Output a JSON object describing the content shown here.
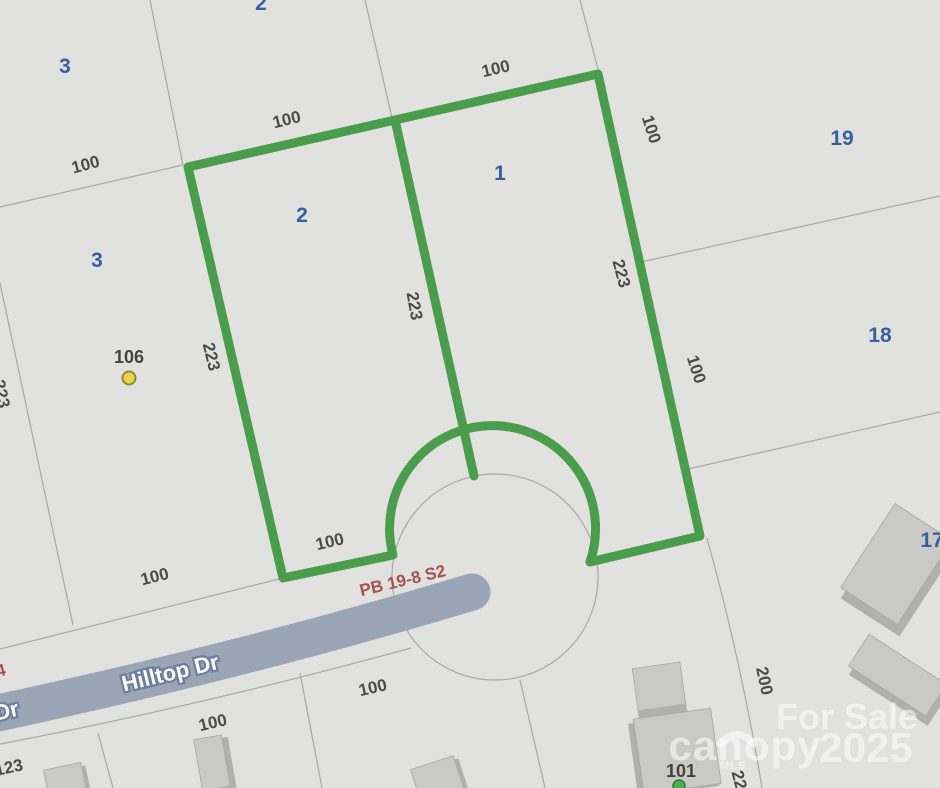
{
  "map": {
    "road": {
      "name": "Hilltop Dr",
      "name_partial": "Dr"
    },
    "plat": {
      "label": "PB 19-8 S2",
      "label_partial": "4"
    },
    "lot_numbers": [
      {
        "text": "3"
      },
      {
        "text": "2"
      },
      {
        "text": "3"
      },
      {
        "text": "2"
      },
      {
        "text": "1"
      },
      {
        "text": "19"
      },
      {
        "text": "18"
      },
      {
        "text": "17"
      }
    ],
    "dimensions": [
      {
        "text": "100"
      },
      {
        "text": "100"
      },
      {
        "text": "100"
      },
      {
        "text": "100"
      },
      {
        "text": "223"
      },
      {
        "text": "223"
      },
      {
        "text": "223"
      },
      {
        "text": "100"
      },
      {
        "text": "223"
      },
      {
        "text": "100"
      },
      {
        "text": "100"
      },
      {
        "text": "100"
      },
      {
        "text": "100"
      },
      {
        "text": "200"
      },
      {
        "text": "223"
      },
      {
        "text": "123"
      }
    ],
    "addresses": [
      {
        "text": "106"
      },
      {
        "text": "101"
      }
    ],
    "watermark": {
      "for_sale": "For Sale",
      "brand": "canopy",
      "brand_sub": "MLS",
      "year": "2025"
    },
    "colors": {
      "parcel_outline_green": "#4a9d4a",
      "road_fill": "#9aa5b5",
      "plat_text_red": "#a8504a",
      "lot_number_blue": "#3a5f9e",
      "dimension_gray": "#4b4b49",
      "address_point_yellow": "#e8d44f",
      "address_point_green": "#4caf50",
      "background": "#e1e1e0"
    }
  }
}
